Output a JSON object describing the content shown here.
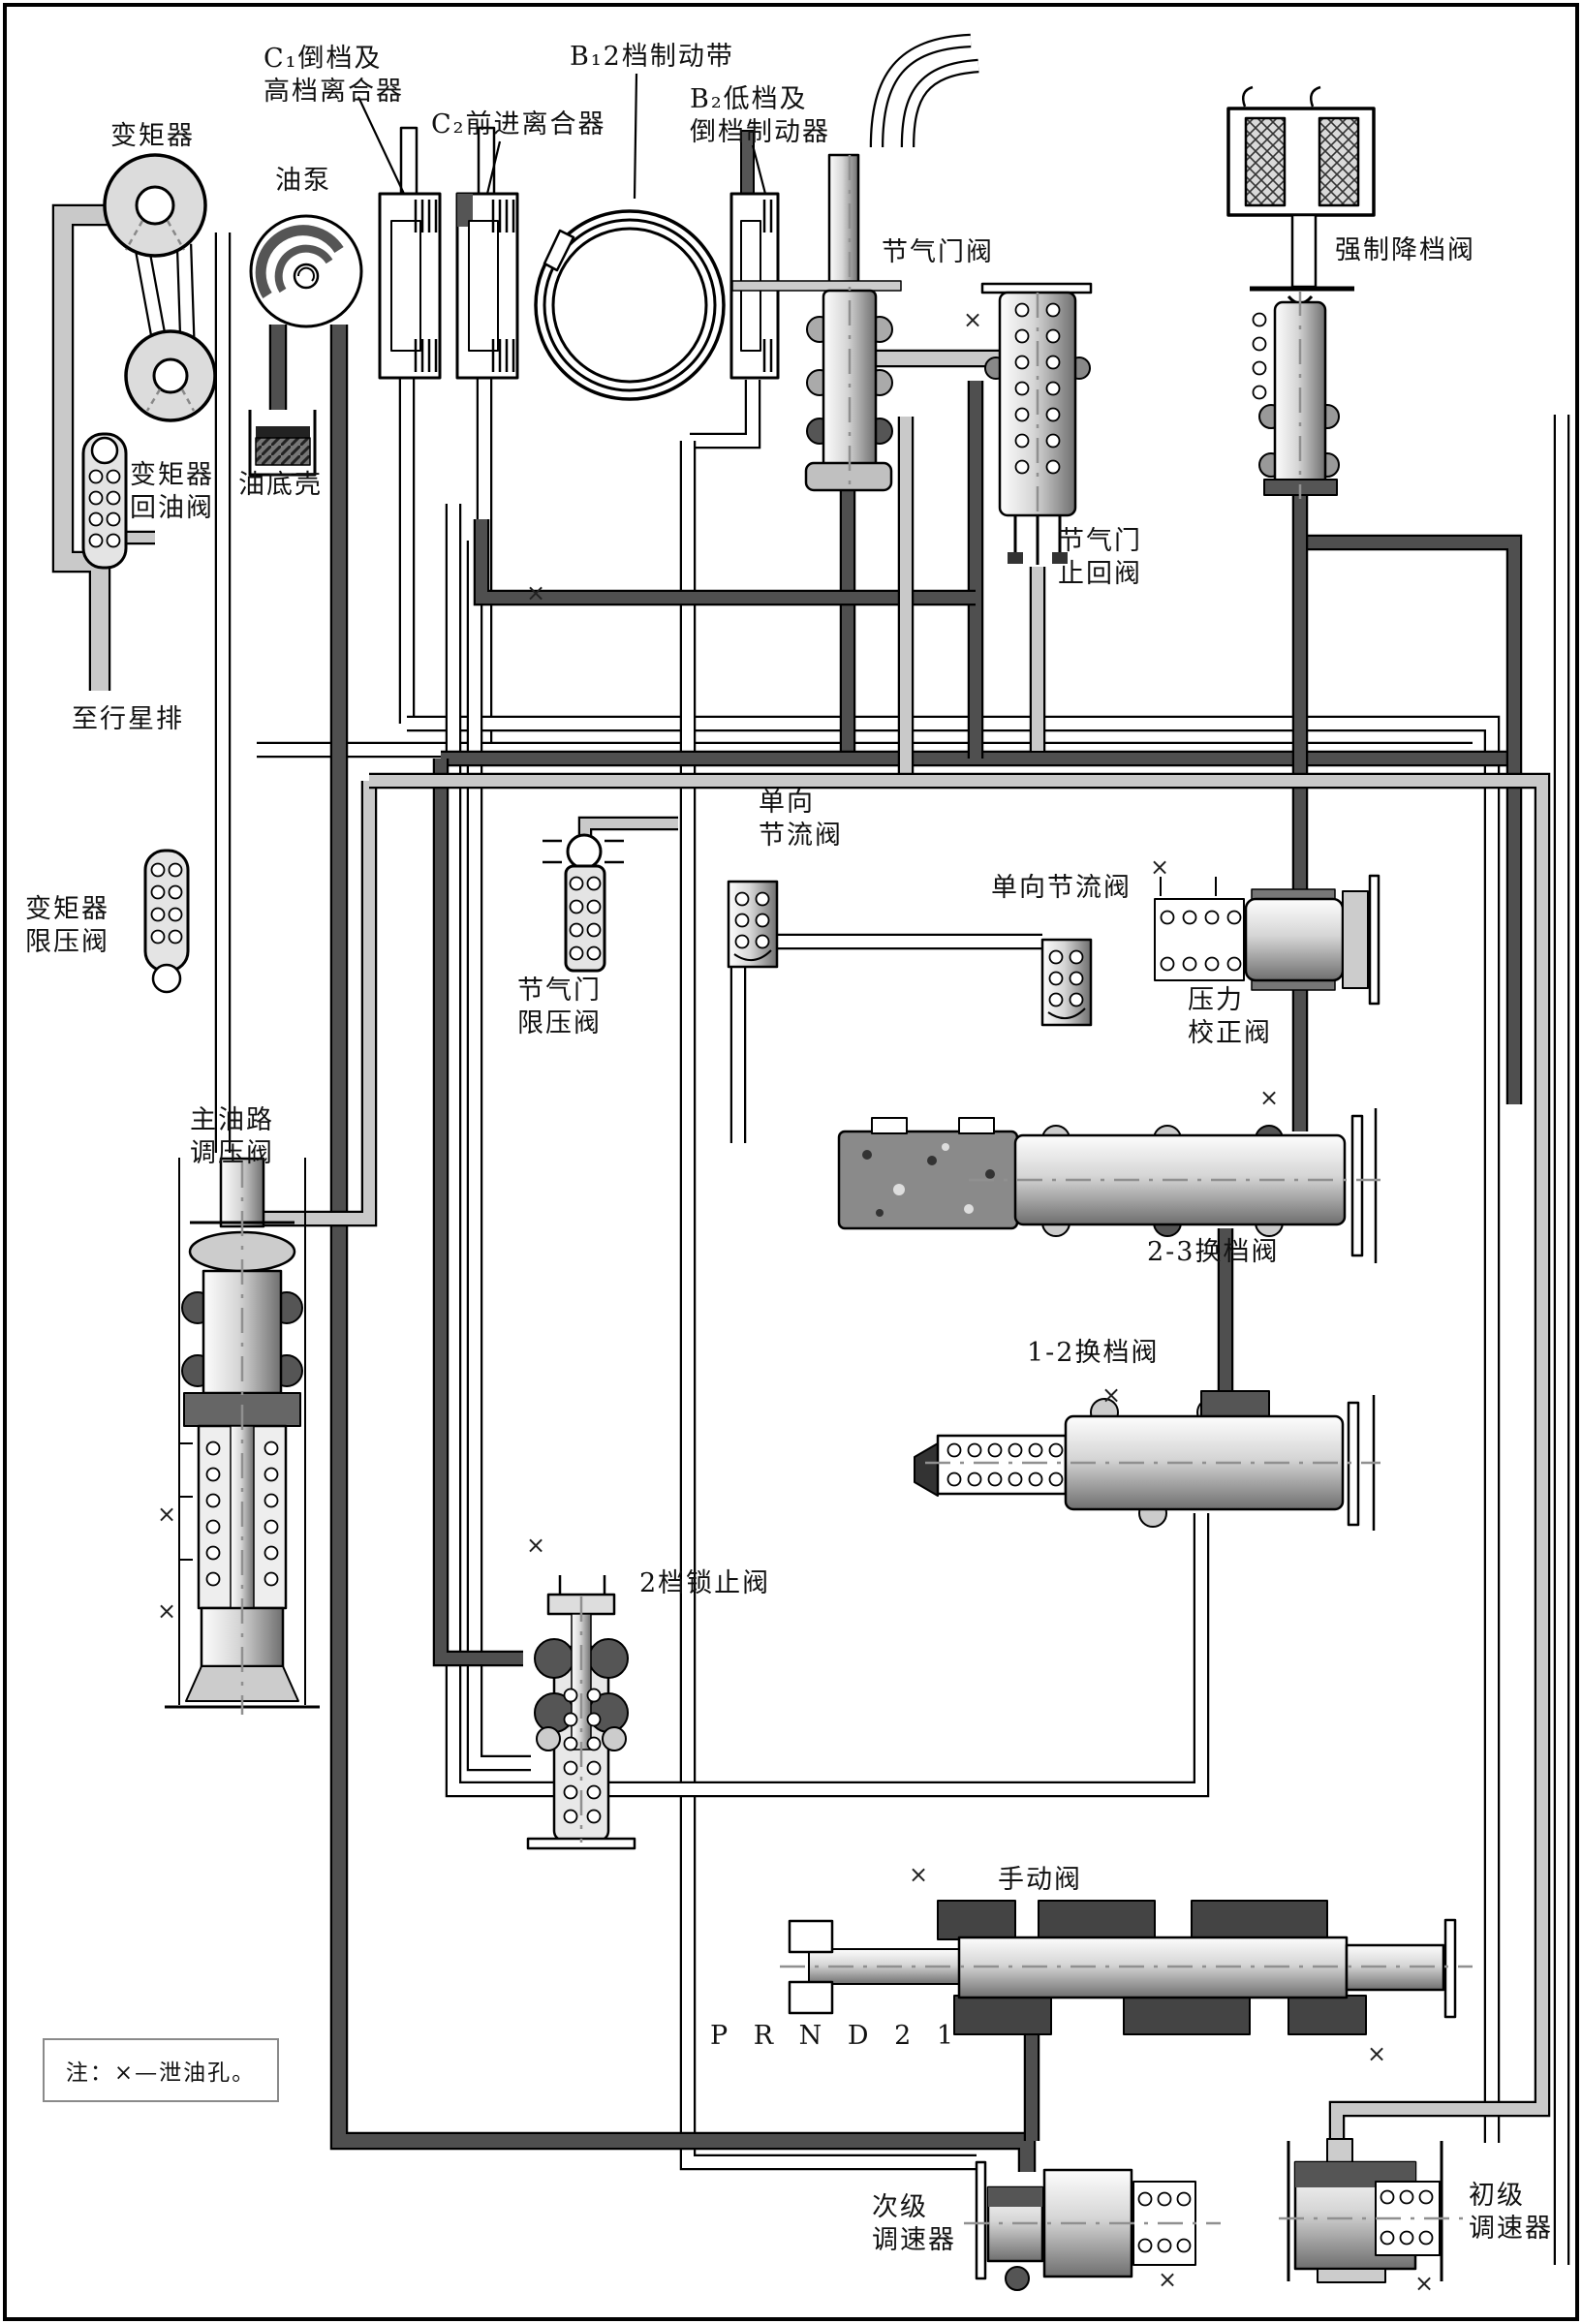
{
  "figure": {
    "note": "注：×—泄油孔。",
    "gear_positions": "P R N D 2 1",
    "drain_symbol": "×"
  },
  "labels": {
    "torque_converter": "变矩器",
    "oil_pump": "油泵",
    "c1_clutch": "C₁倒档及\n高档离合器",
    "c2_clutch": "C₂前进离合器",
    "b1_band": "B₁2档制动带",
    "b2_brake": "B₂低档及\n倒档制动器",
    "throttle_valve": "节气门阀",
    "kickdown_valve": "强制降档阀",
    "converter_return_valve": "变矩器\n回油阀",
    "oil_pan": "油底壳",
    "to_planetary": "至行星排",
    "converter_limit_valve": "变矩器\n限压阀",
    "throttle_check_valve": "节气门\n止回阀",
    "oneway_throttle_valve_left": "单向\n节流阀",
    "oneway_throttle_valve_right": "单向节流阀",
    "throttle_limit_valve": "节气门\n限压阀",
    "pressure_correction_valve": "压力\n校正阀",
    "main_pressure_regulator": "主油路\n调压阀",
    "shift_valve_23": "2-3换档阀",
    "shift_valve_12": "1-2换档阀",
    "second_gear_lock_valve": "2档锁止阀",
    "manual_valve": "手动阀",
    "secondary_governor": "次级\n调速器",
    "primary_governor": "初级\n调速器"
  },
  "colors": {
    "pipe_light": "#c9c9c9",
    "pipe_dark": "#4f4f4f",
    "pipe_white": "#ffffff"
  }
}
